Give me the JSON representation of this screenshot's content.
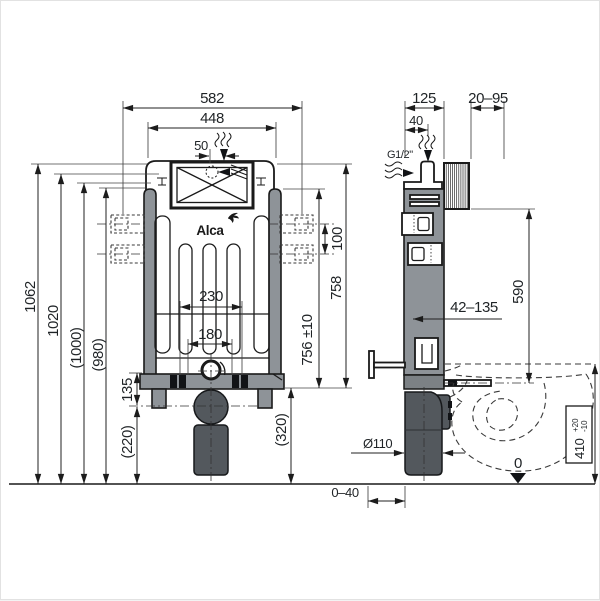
{
  "drawing": {
    "brand": "Alca",
    "front": {
      "overall_width": "582",
      "cistern_width": "448",
      "inlet_offset": "50",
      "height_total": "1062",
      "height_2": "1020",
      "height_3": "(1000)",
      "height_4": "(980)",
      "bracket_spacing": "100",
      "frame_height": "758",
      "panel_height": "756 ±10",
      "bolt_spacing": "230",
      "inner_spacing": "180",
      "base_to_outlet": "135",
      "outlet_center": "(220)",
      "outlet_side": "(320)"
    },
    "side": {
      "frame_depth": "125",
      "wall_range": "20–95",
      "inlet_depth": "40",
      "inlet_thread": "G1/2\"",
      "bracket_height": "590",
      "wall_distance": "42–135",
      "drain_diameter": "Ø110",
      "bowl_height": "410",
      "bowl_tol_plus": "+20",
      "bowl_tol_minus": "-10",
      "floor_level": "0",
      "foot_range": "0–40"
    },
    "colors": {
      "frame_gray": "#8e9398",
      "pipe_dark": "#53585d",
      "outline": "#1a1a1a",
      "background": "#ffffff"
    }
  }
}
